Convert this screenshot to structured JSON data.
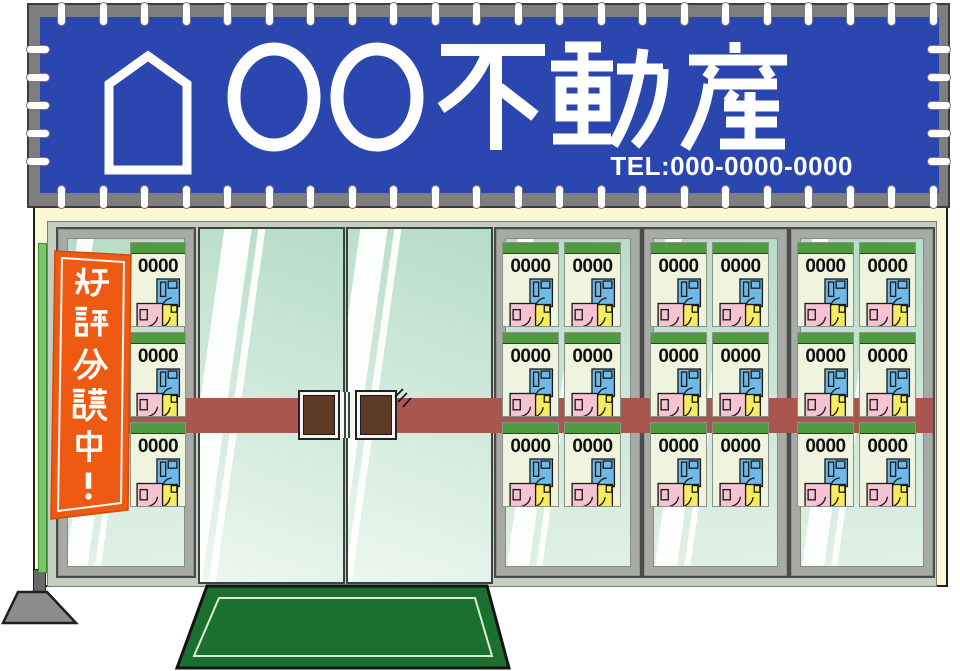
{
  "sign": {
    "company_name": "〇〇不動産",
    "tel": "TEL:000-0000-0000"
  },
  "nobori": {
    "text": "好評分譲中！"
  },
  "storefront": {
    "flyer_label": "0000",
    "flyer_count": 21
  },
  "colors": {
    "banner-blue": "#2b46ae",
    "banner-frame": "#7e7e7e",
    "facade-cream": "#fbf8d5",
    "nobori-orange": "#ee5a12",
    "band-red": "#a9564f",
    "mat-green": "#1b7030",
    "flyer-green": "#4f9b40",
    "handle-brown": "#5d3a23",
    "glass-mint": "#c9e7d7"
  }
}
